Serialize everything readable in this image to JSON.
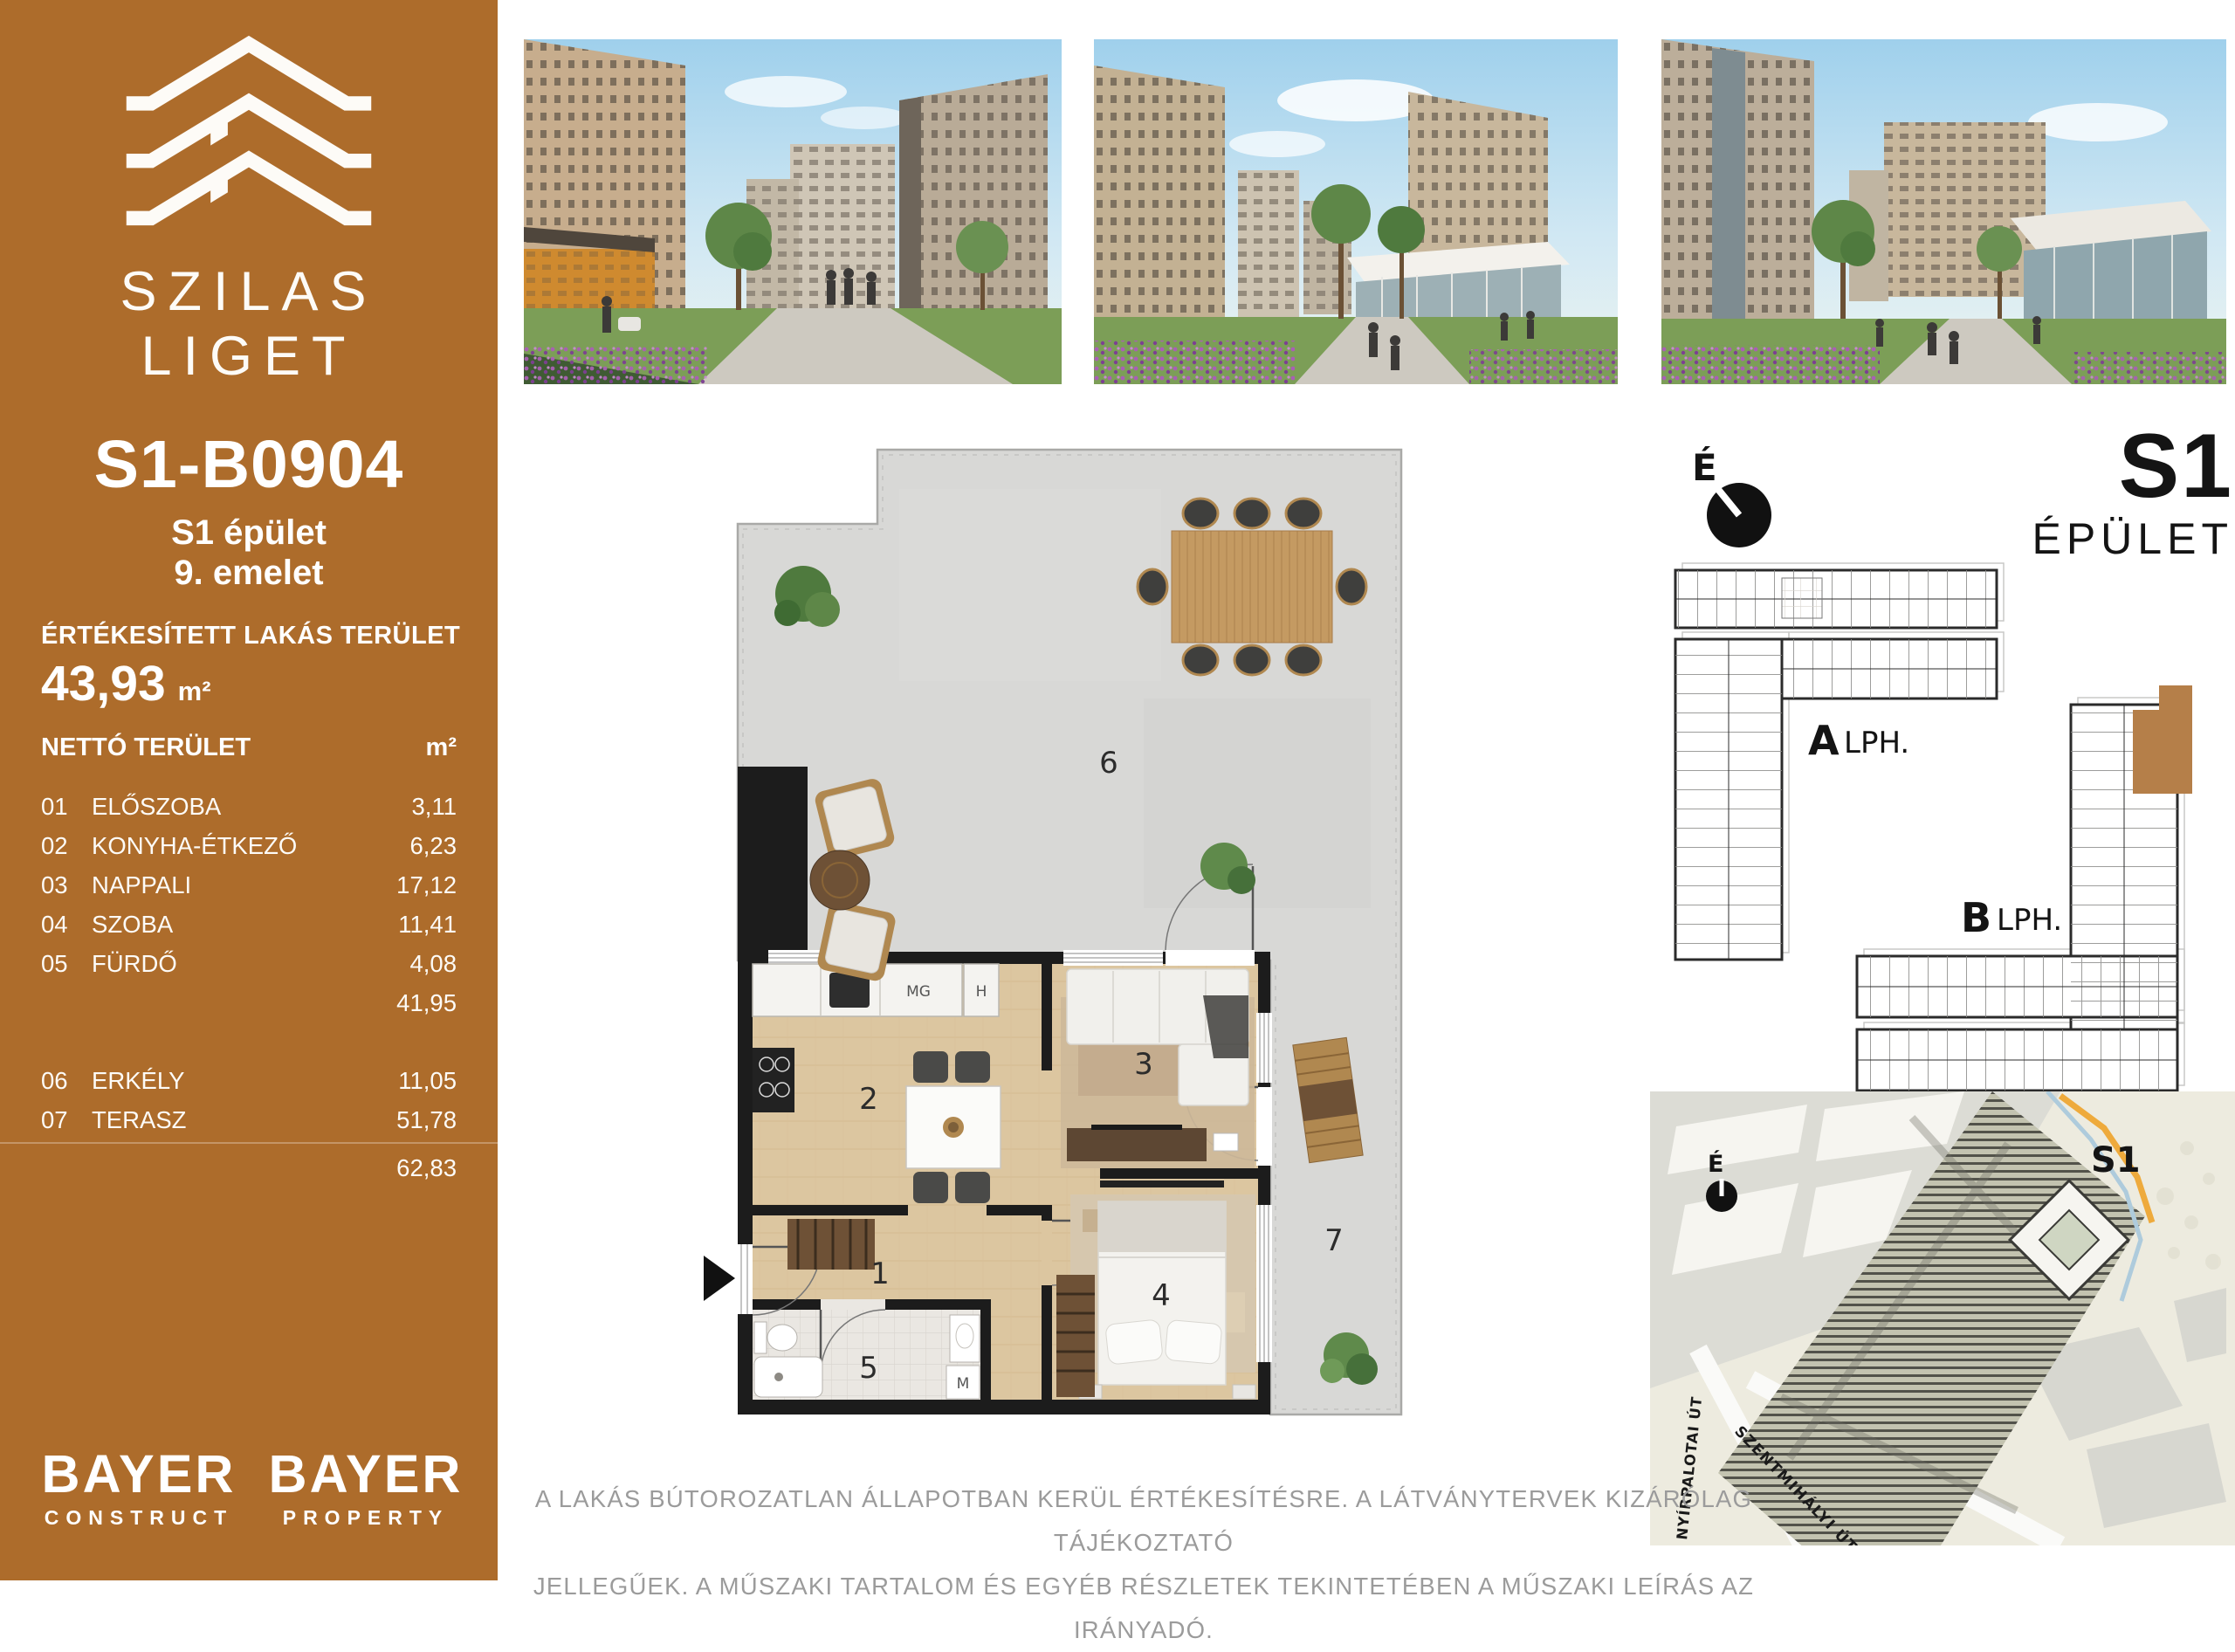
{
  "colors": {
    "brand_brown": "#ad6c2b",
    "unit_highlight": "#b57f49",
    "wall_black": "#1c1c1c",
    "wood_floor": "#dcc6a0",
    "terrace_gray": "#d8d8d6",
    "bath_tile": "#eae7e2",
    "map_beige": "#edebdf",
    "map_orange": "#eeaa3c",
    "map_blue": "#aecbdc",
    "disclaimer_gray": "#9b9b9b"
  },
  "sidebar": {
    "brand_line1": "SZILAS",
    "brand_line2": "LIGET",
    "unit_id": "S1-B0904",
    "building": "S1 épület",
    "floor": "9. emelet",
    "sold_area_label": "ÉRTÉKESÍTETT LAKÁS TERÜLET",
    "sold_area_value": "43,93",
    "area_unit": "m²",
    "net_area_label": "NETTÓ TERÜLET",
    "rooms": [
      {
        "num": "01",
        "name": "ELŐSZOBA",
        "area": "3,11"
      },
      {
        "num": "02",
        "name": "KONYHA-ÉTKEZŐ",
        "area": "6,23"
      },
      {
        "num": "03",
        "name": "NAPPALI",
        "area": "17,12"
      },
      {
        "num": "04",
        "name": "SZOBA",
        "area": "11,41"
      },
      {
        "num": "05",
        "name": "FÜRDŐ",
        "area": "4,08"
      }
    ],
    "rooms_subtotal": "41,95",
    "outdoor": [
      {
        "num": "06",
        "name": "ERKÉLY",
        "area": "11,05"
      },
      {
        "num": "07",
        "name": "TERASZ",
        "area": "51,78"
      }
    ],
    "outdoor_total": "62,83",
    "logo_construct": {
      "line1": "BAYER",
      "line2": "CONSTRUCT"
    },
    "logo_property": {
      "line1": "BAYER",
      "line2": "PROPERTY"
    }
  },
  "floor_plan": {
    "room_numbers": {
      "hall": "1",
      "kitchen": "2",
      "living": "3",
      "bedroom": "4",
      "bath": "5",
      "terrace": "6",
      "balcony": "7"
    },
    "appliance_labels": {
      "dishwasher": "MG",
      "fridge": "H",
      "washer": "M"
    }
  },
  "building_overview": {
    "north": "É",
    "title": "S1",
    "subtitle": "ÉPÜLET",
    "wing_a": "A",
    "wing_a_label": "LPH.",
    "wing_b": "B",
    "wing_b_label": "LPH."
  },
  "site_map": {
    "north": "É",
    "building_label": "S1",
    "street_left": "NYÍRPALOTAI ÚT",
    "street_bottom": "SZENTMIHÁLYI ÚT"
  },
  "disclaimer": {
    "line1": "A LAKÁS BÚTOROZATLAN ÁLLAPOTBAN KERÜL ÉRTÉKESÍTÉSRE. A LÁTVÁNYTERVEK KIZÁRÓLAG TÁJÉKOZTATÓ",
    "line2": "JELLEGŰEK. A MŰSZAKI TARTALOM ÉS EGYÉB RÉSZLETEK TEKINTETÉBEN A MŰSZAKI LEÍRÁS AZ IRÁNYADÓ."
  }
}
